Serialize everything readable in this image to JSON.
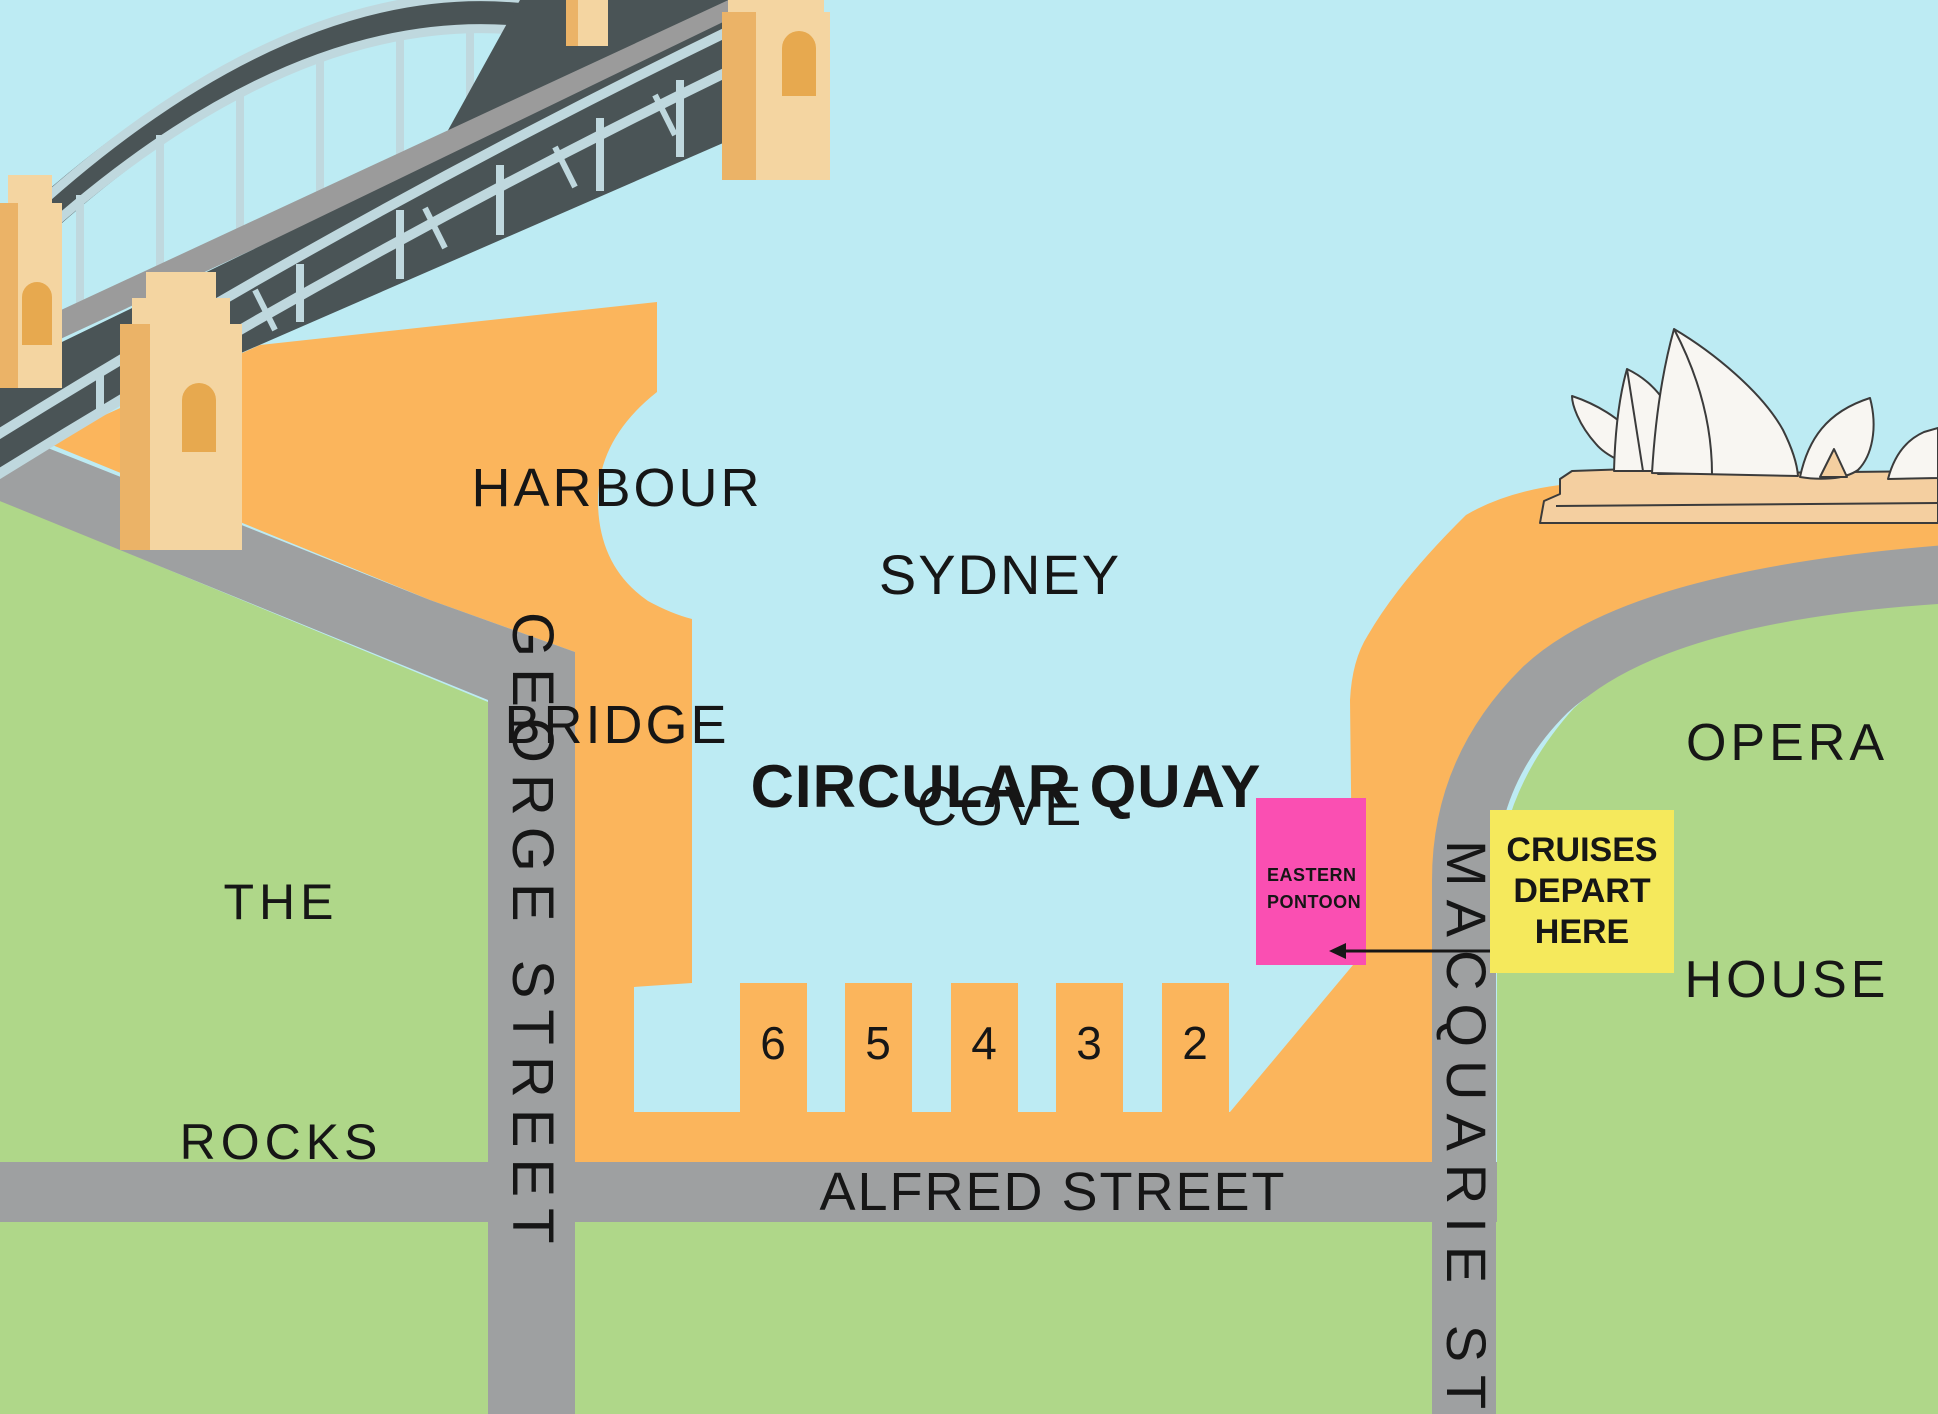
{
  "title": "Circular Quay cruise departure map",
  "labels": {
    "harbour_bridge": [
      "HARBOUR",
      "BRIDGE"
    ],
    "sydney_cove": [
      "SYDNEY",
      "COVE"
    ],
    "the_rocks": [
      "THE",
      "ROCKS"
    ],
    "opera_house": [
      "OPERA",
      "HOUSE"
    ],
    "circular_quay": "CIRCULAR QUAY",
    "alfred_street": "ALFRED STREET",
    "george_street": "GEORGE STREET",
    "macquarie_street": "MACQUARIE STREET",
    "eastern_pontoon": [
      "EASTERN",
      "PONTOON"
    ],
    "cruises_depart": [
      "CRUISES",
      "DEPART",
      "HERE"
    ]
  },
  "wharves": [
    "6",
    "5",
    "4",
    "3",
    "2"
  ],
  "icons": {
    "departure_arrow": "left-arrow",
    "harbour_bridge": "isometric steel arch bridge",
    "opera_house": "white sail roofs on tan platform"
  },
  "colors": {
    "water": "#BDEBF3",
    "quay_orange": "#FBB55C",
    "park_green": "#AFD789",
    "road_gray": "#9EA0A1",
    "bridge_deck": "#4A5456",
    "bridge_road": "#9B9B9B",
    "bridge_steel": "#BFD8DE",
    "pylon_light": "#F4D5A1",
    "pylon_dark": "#EBB367",
    "opera_platform": "#F4CFA0",
    "sail_white": "#F8F6F2",
    "pontoon_pink": "#FA4FB2",
    "callout_yellow": "#F5E95C",
    "text": "#161616"
  }
}
